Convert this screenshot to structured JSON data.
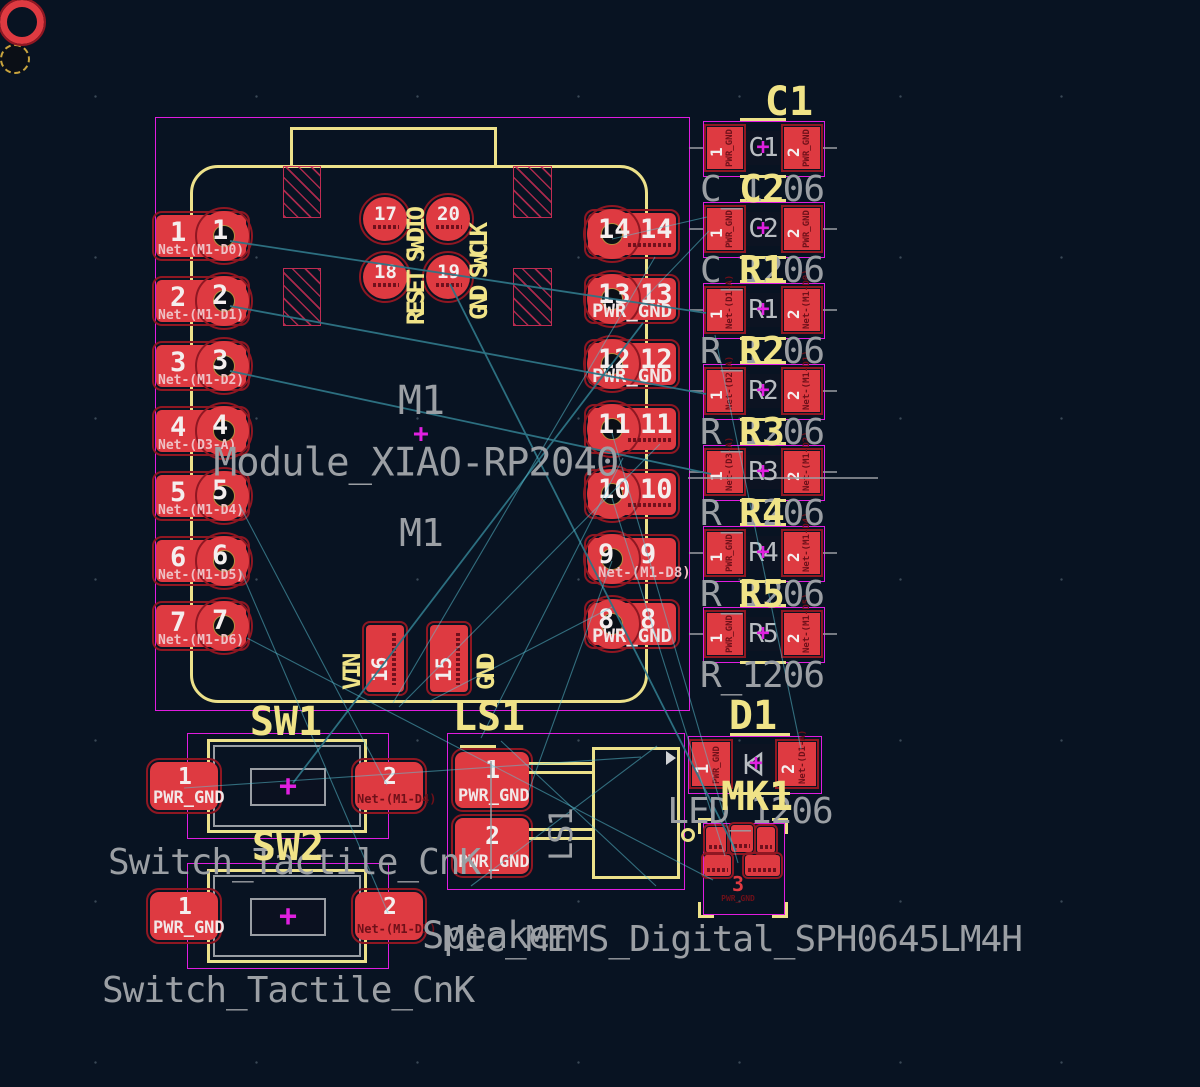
{
  "colors": {
    "background": "#081322",
    "pad_copper_red": "#de3a41",
    "silkscreen_yellow": "#ece18a",
    "fab_gray": "#9b9fa4",
    "courtyard_magenta": "#e01ce0",
    "ratsnest_cyan": "#5cc6d8",
    "trace_teal": "#2e7486",
    "anchor_magenta": "#e020e0"
  },
  "module": {
    "ref_top": "M1",
    "anchor": "+",
    "value": "Module_XIAO-RP2040",
    "ref_bottom": "M1",
    "left_pads": [
      {
        "num": "1",
        "net": "Net-(M1-D0)"
      },
      {
        "num": "2",
        "net": "Net-(M1-D1)"
      },
      {
        "num": "3",
        "net": "Net-(M1-D2)"
      },
      {
        "num": "4",
        "net": "Net-(D3-A)"
      },
      {
        "num": "5",
        "net": "Net-(M1-D4)"
      },
      {
        "num": "6",
        "net": "Net-(M1-D5)"
      },
      {
        "num": "7",
        "net": "Net-(M1-D6)"
      }
    ],
    "right_pads": [
      {
        "num": "14",
        "net": ""
      },
      {
        "num": "13",
        "net": "PWR_GND"
      },
      {
        "num": "12",
        "net": "PWR_GND"
      },
      {
        "num": "11",
        "net": ""
      },
      {
        "num": "10",
        "net": ""
      },
      {
        "num": "9",
        "net": "Net-(M1-D8)"
      },
      {
        "num": "8",
        "net": "PWR_GND"
      }
    ],
    "swd_pads": [
      {
        "num": "17"
      },
      {
        "num": "20"
      },
      {
        "num": "18"
      },
      {
        "num": "19"
      }
    ],
    "swd_label_left": "RESET SWDIO",
    "swd_label_right": "GND SWCLK",
    "power_pads": [
      {
        "num": "16",
        "label": "VIN"
      },
      {
        "num": "15",
        "label": "GND"
      }
    ]
  },
  "passives": [
    {
      "ref": "C1",
      "fp": "C_1206",
      "pads": [
        {
          "num": "1",
          "net": "PWR_GND"
        },
        {
          "num": "2",
          "net": "PWR_GND"
        }
      ]
    },
    {
      "ref": "C2",
      "fp": "C_1206",
      "pads": [
        {
          "num": "1",
          "net": "PWR_GND"
        },
        {
          "num": "2",
          "net": "PWR_GND"
        }
      ]
    },
    {
      "ref": "R1",
      "fp": "R_1206",
      "pads": [
        {
          "num": "1",
          "net": "Net-(D1-A)"
        },
        {
          "num": "2",
          "net": "Net-(M1-D0)"
        }
      ]
    },
    {
      "ref": "R2",
      "fp": "R_1206",
      "pads": [
        {
          "num": "1",
          "net": "Net-(D2-A)"
        },
        {
          "num": "2",
          "net": "Net-(M1-D1)"
        }
      ]
    },
    {
      "ref": "R3",
      "fp": "R_1206",
      "pads": [
        {
          "num": "1",
          "net": "Net-(D3-A)"
        },
        {
          "num": "2",
          "net": "Net-(M1-D2)"
        }
      ]
    },
    {
      "ref": "R4",
      "fp": "R_1206",
      "pads": [
        {
          "num": "1",
          "net": "PWR_GND"
        },
        {
          "num": "2",
          "net": "Net-(M1-D4)"
        }
      ]
    },
    {
      "ref": "R5",
      "fp": "R_1206",
      "pads": [
        {
          "num": "1",
          "net": "PWR_GND"
        },
        {
          "num": "2",
          "net": "Net-(M1-D5)"
        }
      ]
    }
  ],
  "diode": {
    "ref": "D1",
    "fp": "LED_1206",
    "pads": [
      {
        "num": "1",
        "net": "PWR_GND"
      },
      {
        "num": "2",
        "net": "Net-(D1-A)"
      }
    ]
  },
  "mic": {
    "ref": "MK1",
    "fp": "Mic_MEMS_Digital_SPH0645LM4H",
    "big_pad": {
      "num": "3",
      "net": "PWR_GND"
    }
  },
  "switches": [
    {
      "ref": "SW1",
      "fp": "Switch_Tactile_CnK",
      "anchor": "+",
      "pads": [
        {
          "num": "1",
          "net": "PWR_GND"
        },
        {
          "num": "2",
          "net": "Net-(M1-D4)"
        }
      ]
    },
    {
      "ref": "SW2",
      "fp": "Switch_Tactile_CnK",
      "anchor": "+",
      "pads": [
        {
          "num": "1",
          "net": "PWR_GND"
        },
        {
          "num": "2",
          "net": "Net-(M1-D5)"
        }
      ]
    }
  ],
  "speaker": {
    "ref": "LS1",
    "fp": "Speaker",
    "side_label": "LS1",
    "pads": [
      {
        "num": "1",
        "net": "PWR_GND"
      },
      {
        "num": "2",
        "net": "PWR_GND"
      }
    ]
  }
}
